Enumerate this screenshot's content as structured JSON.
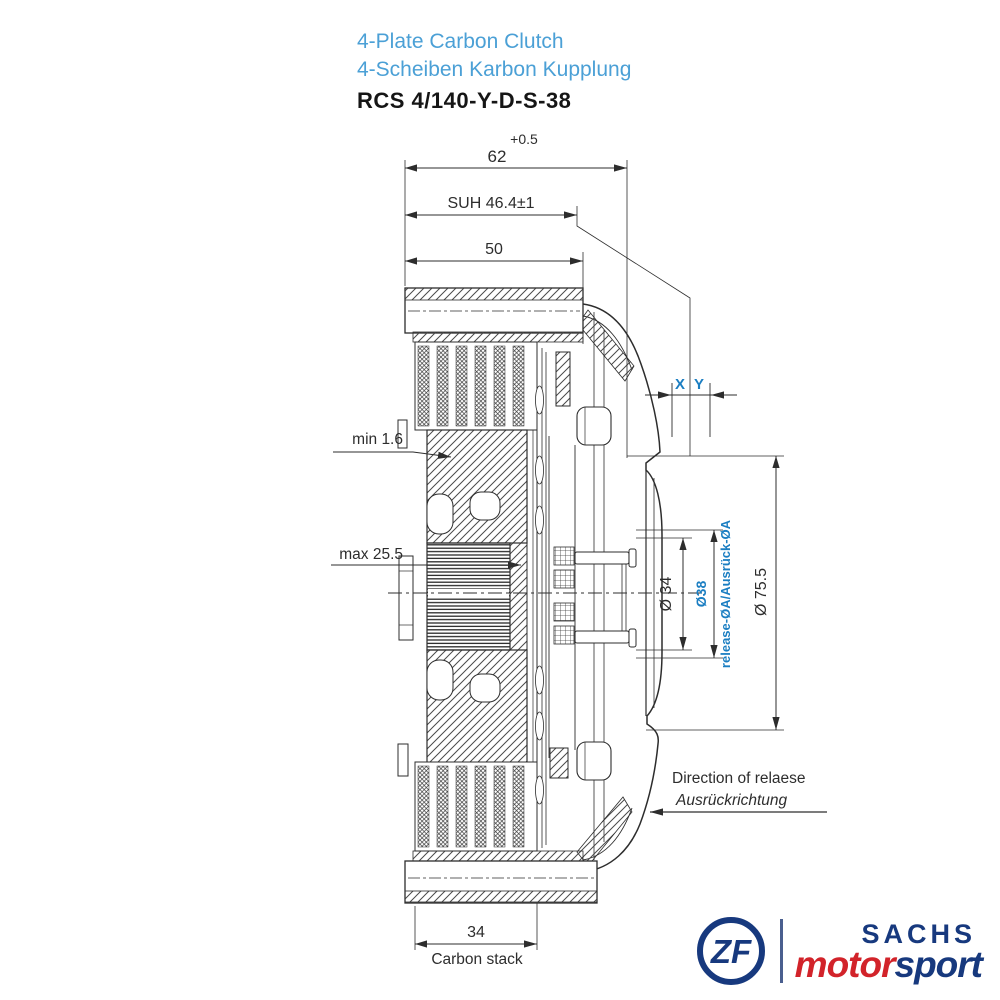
{
  "title": {
    "product_en": "4-Plate Carbon Clutch",
    "product_de": "4-Scheiben Karbon Kupplung",
    "part_number": "RCS 4/140-Y-D-S-38"
  },
  "dims": {
    "width_total": "62",
    "width_total_tol": "+0.5",
    "suh": "SUH 46.4±1",
    "depth_50": "50",
    "min_wear": "min 1.6",
    "max_travel": "max 25.5",
    "x": "X",
    "y": "Y",
    "dia34": "Ø 34",
    "dia38": "Ø38",
    "release_dia": "release-ØA/Ausrück-ØA",
    "dia75": "Ø 75.5",
    "stack_width": "34",
    "stack_label": "Carbon stack",
    "direction_en": "Direction of relaese",
    "direction_de": "Ausrückrichtung"
  },
  "logo": {
    "zf": "ZF",
    "sachs": "SACHS",
    "motor": "motor",
    "sport": "sport"
  },
  "colors": {
    "title_blue": "#4BA0D6",
    "accent_blue": "#1B7EC2",
    "line": "#2D2D2D",
    "logo_navy": "#17397E",
    "logo_red": "#D2232A"
  }
}
